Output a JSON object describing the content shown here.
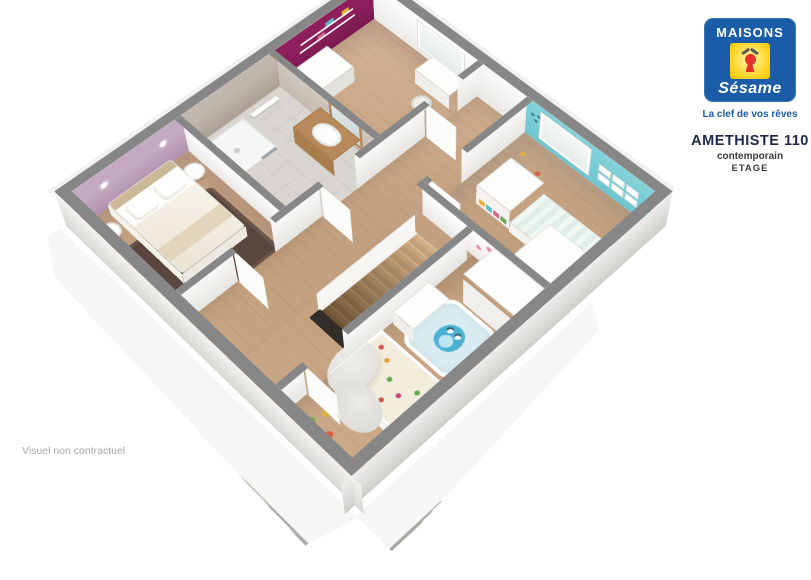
{
  "branding": {
    "brand_top": "MAISONS",
    "brand_bottom": "Sésame",
    "tagline": "La clef de vos rêves"
  },
  "plan_info": {
    "model": "AMETHISTE 110",
    "style": "contemporain",
    "level": "ETAGE"
  },
  "footer": {
    "disclaimer": "Visuel non contractuel"
  },
  "palette": {
    "brand_blue": "#1a5ca8",
    "brand_yellow": "#ffd31e",
    "brand_red": "#e53329",
    "title_navy": "#1d2947",
    "text_dark": "#3c3c3c",
    "text_gray": "#a8a8a8",
    "wall_top": "#878787",
    "magenta_wall": "#8d1f5c",
    "cyan_wall": "#85d3da",
    "mauve_wall": "#c4a9c2",
    "greige_wall": "#c2b7ac",
    "wood_floor": "#c9aa8b",
    "bath_floor": "#d9d5d0",
    "stair_wood": "#c29764",
    "rug_brown": "#5a463c",
    "rug_owl": "#d8ecf2"
  }
}
